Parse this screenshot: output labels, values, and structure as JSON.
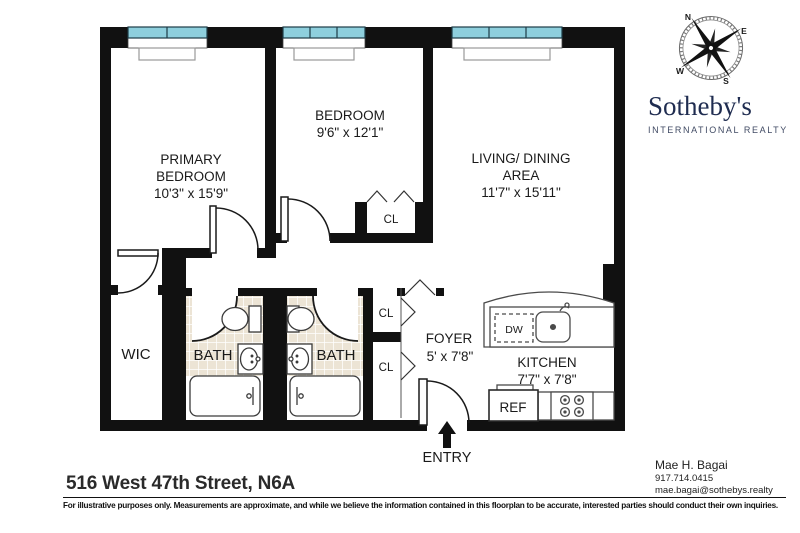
{
  "meta": {
    "address": "516 West 47th Street, N6A",
    "disclaimer": "For illustrative purposes only.  Measurements are approximate, and while we believe the information contained in this floorplan to be accurate, interested parties should conduct their own inquiries."
  },
  "brand": {
    "name": "Sotheby's",
    "tagline": "INTERNATIONAL REALTY",
    "navy": "#1f2c50"
  },
  "agent": {
    "name": "Mae H. Bagai",
    "phone": "917.714.0415",
    "email": "mae.bagai@sothebys.realty"
  },
  "compass": {
    "n": "N",
    "e": "E",
    "s": "S",
    "w": "W"
  },
  "rooms": {
    "primary": {
      "line1": "PRIMARY",
      "line2": "BEDROOM",
      "dims": "10'3\" x 15'9\""
    },
    "bedroom": {
      "line1": "BEDROOM",
      "dims": "9'6\" x 12'1\""
    },
    "living": {
      "line1": "LIVING/ DINING",
      "line2": "AREA",
      "dims": "11'7\" x 15'11\""
    },
    "kitchen": {
      "line1": "KITCHEN",
      "dims": "7'7\" x 7'8\""
    },
    "foyer": {
      "line1": "FOYER",
      "dims": "5' x 7'8\""
    },
    "wic": "WIC",
    "bath1": "BATH",
    "bath2": "BATH",
    "cl_bedroom": "CL",
    "cl_hall1": "CL",
    "cl_hall2": "CL"
  },
  "fixtures": {
    "dw": "DW",
    "ref": "REF",
    "entry": "ENTRY"
  },
  "colors": {
    "wall": "#111111",
    "window": "#8ECFDD",
    "tile": "#ECE4D5"
  }
}
